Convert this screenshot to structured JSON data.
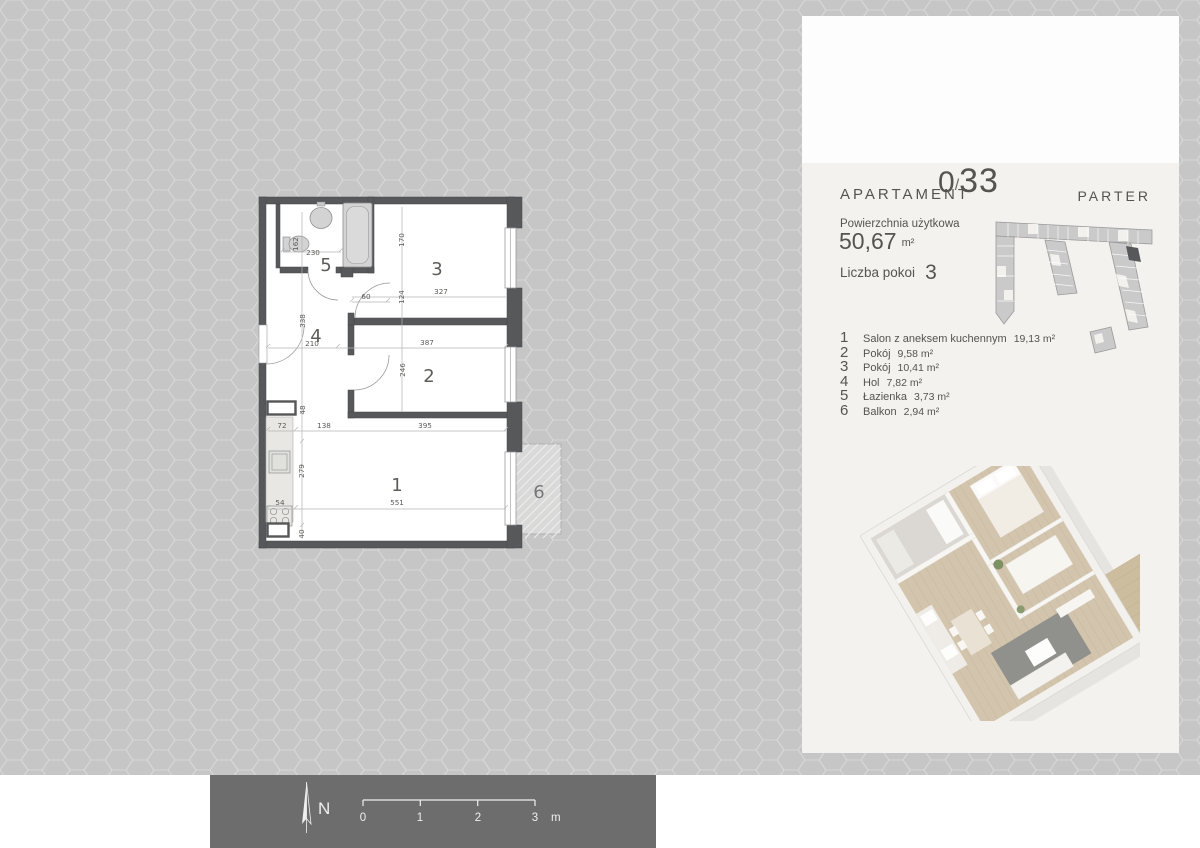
{
  "panel": {
    "header": {
      "label": "APARTAMENT",
      "unit_prefix": "0",
      "separator": "/",
      "unit_number": "33",
      "floor": "PARTER"
    },
    "area": {
      "label": "Powierzchnia użytkowa",
      "value": "50,67",
      "unit": "m²"
    },
    "rooms_count": {
      "label": "Liczba pokoi",
      "value": "3"
    },
    "legend": [
      {
        "no": "1",
        "name": "Salon z aneksem kuchennym",
        "area": "19,13 m²"
      },
      {
        "no": "2",
        "name": "Pokój",
        "area": "9,58 m²"
      },
      {
        "no": "3",
        "name": "Pokój",
        "area": "10,41 m²"
      },
      {
        "no": "4",
        "name": "Hol",
        "area": "7,82 m²"
      },
      {
        "no": "5",
        "name": "Łazienka",
        "area": "3,73 m²"
      },
      {
        "no": "6",
        "name": "Balkon",
        "area": "2,94 m²"
      }
    ]
  },
  "plan": {
    "rooms": [
      "1",
      "2",
      "3",
      "4",
      "5",
      "6"
    ],
    "dims": [
      "230",
      "162",
      "170",
      "124",
      "327",
      "60",
      "338",
      "210",
      "387",
      "246",
      "48",
      "72",
      "138",
      "395",
      "279",
      "54",
      "551",
      "40"
    ]
  },
  "footer": {
    "north": "N",
    "ticks": [
      "0",
      "1",
      "2",
      "3"
    ],
    "unit": "m"
  },
  "colors": {
    "wall": "#57585a",
    "hex_bg": "#c6c6c6",
    "hex_line": "#d7d7d7",
    "panel_bg": "#f3f2ef",
    "footer_bar": "#6d6d6d",
    "text": "#55544e",
    "highlighted_unit": "#57585a"
  }
}
